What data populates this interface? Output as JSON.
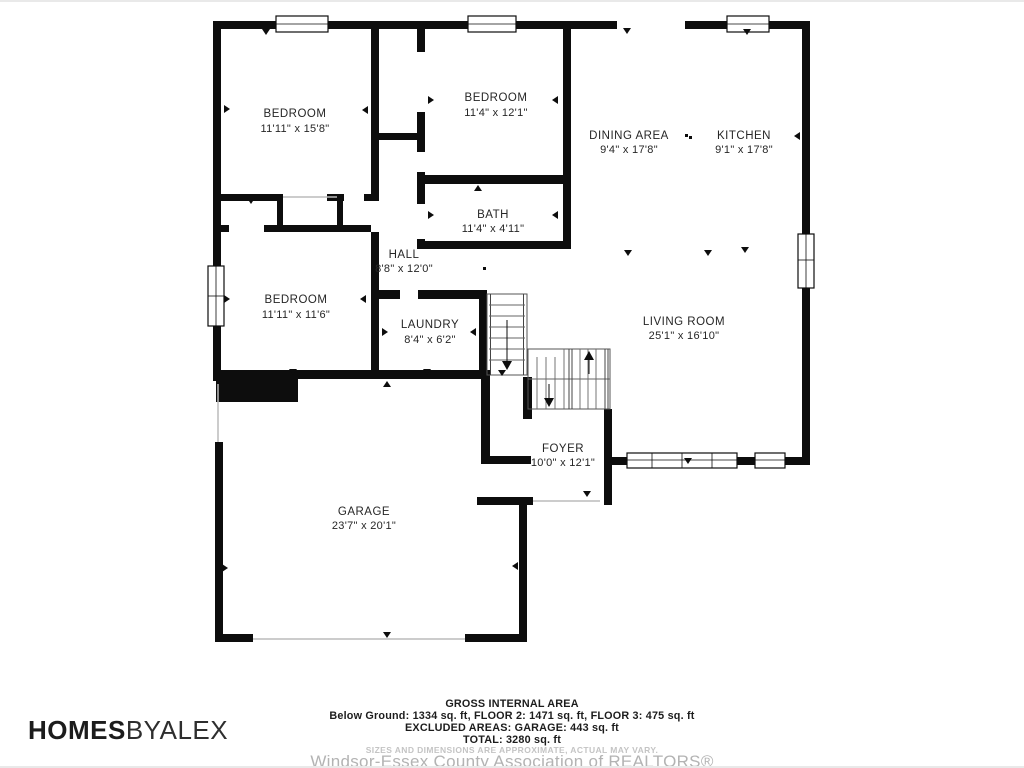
{
  "rooms": {
    "bedroom1": {
      "name": "BEDROOM",
      "dims": "11'11\" x 15'8\""
    },
    "bedroom2": {
      "name": "BEDROOM",
      "dims": "11'4\" x 12'1\""
    },
    "dining": {
      "name": "DINING AREA",
      "dims": "9'4\" x 17'8\""
    },
    "kitchen": {
      "name": "KITCHEN",
      "dims": "9'1\" x 17'8\""
    },
    "bath": {
      "name": "BATH",
      "dims": "11'4\" x 4'11\""
    },
    "hall": {
      "name": "HALL",
      "dims": "8'8\" x 12'0\""
    },
    "bedroom3": {
      "name": "BEDROOM",
      "dims": "11'11\" x 11'6\""
    },
    "laundry": {
      "name": "LAUNDRY",
      "dims": "8'4\" x 6'2\""
    },
    "living": {
      "name": "LIVING ROOM",
      "dims": "25'1\" x 16'10\""
    },
    "foyer": {
      "name": "FOYER",
      "dims": "10'0\" x 12'1\""
    },
    "garage": {
      "name": "GARAGE",
      "dims": "23'7\" x 20'1\""
    }
  },
  "summary": {
    "title": "GROSS INTERNAL AREA",
    "line1": "Below Ground: 1334 sq. ft, FLOOR 2: 1471 sq. ft, FLOOR 3: 475 sq. ft",
    "line2": "EXCLUDED AREAS: GARAGE: 443 sq. ft",
    "line3": "TOTAL: 3280 sq. ft",
    "disclaimer": "SIZES AND DIMENSIONS ARE APPROXIMATE, ACTUAL MAY VARY.",
    "watermark": "Windsor-Essex County Association of REALTORS®"
  },
  "branding": {
    "logo_bold": "HOMES",
    "logo_light": "BYALEX"
  },
  "colors": {
    "wall": "#0d0d0d",
    "label_text": "#262626",
    "muted_text": "#b3b3b3",
    "background": "#ffffff"
  }
}
